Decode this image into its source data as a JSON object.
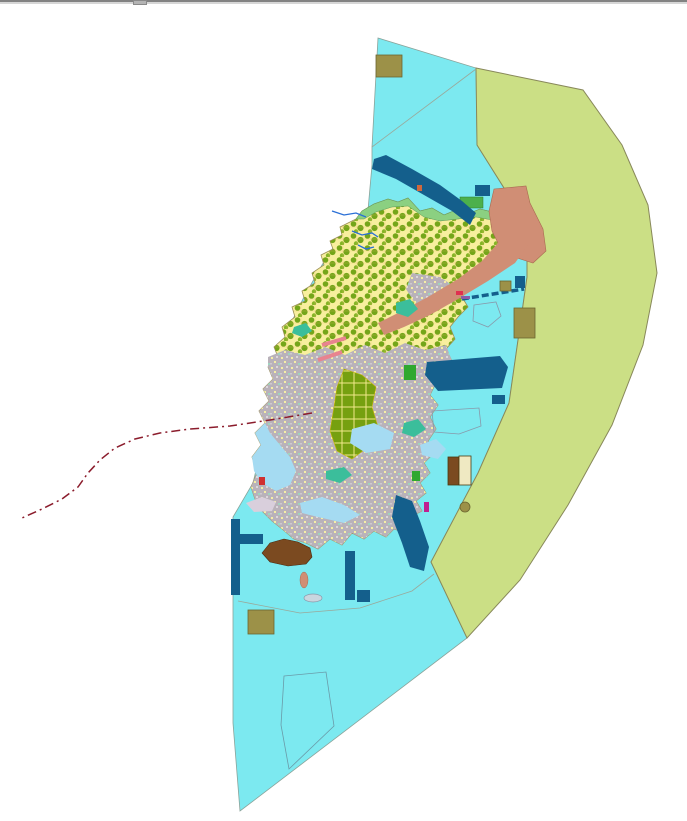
{
  "window": {
    "top_divider": {
      "present": true,
      "handle_x": 133
    }
  },
  "map": {
    "background": "#FFFFFF",
    "palette": {
      "sea": "#7CE9F0",
      "coastal_zone": "#CBDF85",
      "farmland_yellow": "#F8EF9E",
      "forest_green": "#74A619",
      "urban_gray": "#B9B2BA",
      "shore_green": "#8BD081",
      "salmon_zone": "#D08E75",
      "harbor_blue": "#145F8C",
      "khaki_site": "#9C9148",
      "brown_site": "#7B4A20",
      "beige_site": "#EFE9C2",
      "inlet_blue": "#A5DBF2",
      "teal_patch": "#3BBE9B",
      "boundary_maroon": "#8B1C2C",
      "outline_gray": "#8899AA",
      "stream_blue": "#2A6FD6",
      "pink_road": "#E8838F"
    },
    "features": [
      {
        "name": "sea-area",
        "type": "polygon",
        "fill": "#7CE9F0",
        "stroke": "#8aa39a",
        "stroke_width": 0.8,
        "points": "378,33 476,63 477,140 504,183 527,250 527,272 509,398 478,468 431,557 467,633 240,806 233,718 233,512 253,478 262,440 270,400 278,360 290,320 305,290 322,260 338,235 352,218 368,205 372,160 372,142"
      },
      {
        "name": "coastal-zone-area",
        "type": "polygon",
        "fill": "#CBDF85",
        "stroke": "#88885A",
        "stroke_width": 1,
        "points": "476,63 583,85 622,140 648,200 657,268 643,340 612,420 568,500 520,575 467,633 431,557 478,468 509,398 527,272 527,250 504,183 477,140"
      },
      {
        "name": "sea-boundary-line-nw",
        "type": "polyline",
        "stroke": "#9aa89a",
        "stroke_width": 0.8,
        "points": "372,142 476,64"
      },
      {
        "name": "sea-boundary-line-south",
        "type": "polyline",
        "stroke": "#9aa89a",
        "stroke_width": 0.8,
        "points": "238,596 300,608 360,603 412,586 434,569"
      },
      {
        "name": "island-base",
        "type": "polygon",
        "fill": "pattern:farmland",
        "stroke": "#9a8f55",
        "stroke_width": 0.8,
        "points": "356,214 362,206 374,199 388,194 398,197 408,193 420,206 432,203 444,210 456,205 468,209 480,204 492,207 500,203 508,210 514,218 520,228 518,240 508,252 496,262 484,272 470,282 462,292 468,302 458,312 450,322 455,334 446,344 452,356 444,362 434,358 428,366 436,378 430,390 438,400 430,412 436,424 428,436 434,448 424,458 430,468 420,478 426,488 416,496 422,506 410,512 414,520 402,518 406,528 394,524 386,532 374,526 364,534 352,528 342,540 330,534 318,544 306,538 294,534 282,524 272,516 262,506 255,494 251,482 257,468 252,452 261,440 255,428 265,418 259,406 269,396 263,384 273,374 268,362 278,352 274,342 285,332 282,322 295,312 292,302 305,296 302,286 315,278 312,268 324,260 321,250 333,244 330,236 342,230 340,222 352,216"
      },
      {
        "name": "island-urban-district",
        "type": "polygon",
        "fill": "pattern:urban",
        "points": "268,352 285,345 305,350 325,342 345,350 365,340 385,348 405,338 425,345 446,340 452,356 444,362 434,358 428,366 436,378 430,390 438,400 430,412 436,424 428,436 434,448 424,458 430,468 420,478 426,488 416,496 422,506 410,512 414,520 402,518 406,528 394,524 386,532 374,526 364,534 352,528 342,540 330,534 318,544 306,538 294,534 282,524 272,516 262,506 255,494 251,482 257,468 252,452 261,440 255,428 265,418 259,406 269,396 263,384 273,374 268,362"
      },
      {
        "name": "urban-patch-northeast",
        "type": "polygon",
        "fill": "pattern:urban",
        "points": "412,268 440,272 458,284 452,298 432,305 415,298 406,284"
      },
      {
        "name": "shore-green-strip-north",
        "type": "polygon",
        "fill": "#8BD081",
        "stroke": "#5f9a58",
        "stroke_width": 0.5,
        "points": "356,214 362,206 374,199 388,194 398,197 408,193 420,206 432,203 444,210 456,205 468,209 480,204 492,207 500,203 508,210 514,218 506,222 492,215 476,212 458,214 440,216 424,212 408,201 392,202 376,207 364,214"
      },
      {
        "name": "salmon-zone-northeast",
        "type": "polygon",
        "fill": "#D08E75",
        "stroke": "#a86a50",
        "stroke_width": 0.6,
        "points": "494,184 526,181 530,198 543,224 546,246 533,258 514,252 500,242 492,226 489,206"
      },
      {
        "name": "salmon-band-east-coast",
        "type": "polygon",
        "fill": "#D08E75",
        "points": "505,230 528,240 515,258 488,276 458,294 430,310 404,322 384,330 378,318 398,308 428,292 458,274 482,256"
      },
      {
        "name": "forest-cluster-central",
        "type": "polygon",
        "fill": "pattern:olive",
        "stroke": "#C8B400",
        "stroke_width": 0.6,
        "points": "344,364 362,370 376,382 372,402 378,422 368,442 352,454 337,446 330,426 334,402 337,382"
      },
      {
        "name": "inlet-west-bay",
        "type": "polygon",
        "fill": "#A5DBF2",
        "points": "252,452 261,440 255,428 265,418 270,428 280,440 290,452 296,466 290,480 276,486 262,478 254,466"
      },
      {
        "name": "inlet-mid-south",
        "type": "polygon",
        "fill": "#A5DBF2",
        "points": "352,424 374,418 394,428 390,444 366,448 350,438"
      },
      {
        "name": "inlet-south",
        "type": "polygon",
        "fill": "#A5DBF2",
        "points": "300,498 322,492 344,500 360,510 344,518 318,512 302,508"
      },
      {
        "name": "inlet-southeast",
        "type": "polygon",
        "fill": "#A5DBF2",
        "points": "420,440 436,434 446,444 438,454 422,450"
      },
      {
        "name": "teal-patch-1",
        "type": "polygon",
        "fill": "#3BBE9B",
        "points": "396,298 410,294 418,304 408,312 396,308"
      },
      {
        "name": "teal-patch-2",
        "type": "polygon",
        "fill": "#3BBE9B",
        "points": "404,418 418,414 426,424 414,432 402,428"
      },
      {
        "name": "teal-patch-3",
        "type": "polygon",
        "fill": "#3BBE9B",
        "points": "326,466 344,462 352,470 340,478 326,474"
      },
      {
        "name": "teal-patch-4",
        "type": "polygon",
        "fill": "#3BBE9B",
        "points": "294,322 306,318 312,326 302,332 292,328"
      },
      {
        "name": "green-site-1",
        "type": "rect",
        "x": 404,
        "y": 360,
        "w": 12,
        "h": 15,
        "fill": "#2FA82F"
      },
      {
        "name": "green-site-2",
        "type": "rect",
        "x": 412,
        "y": 466,
        "w": 8,
        "h": 10,
        "fill": "#2FA82F"
      },
      {
        "name": "green-site-shore",
        "type": "rect",
        "x": 460,
        "y": 192,
        "w": 23,
        "h": 11,
        "fill": "#4CB04C",
        "stroke": "#2a7a2a",
        "stroke_width": 0.5
      },
      {
        "name": "breakwater-northwest",
        "type": "polygon",
        "fill": "#145F8C",
        "points": "374,154 386,150 412,164 440,180 462,196 476,208 470,220 452,206 424,190 396,174 372,164"
      },
      {
        "name": "harbor-rect-north-1",
        "type": "rect",
        "x": 475,
        "y": 180,
        "w": 15,
        "h": 11,
        "fill": "#145F8C"
      },
      {
        "name": "harbor-rect-north-2",
        "type": "rect",
        "x": 456,
        "y": 199,
        "w": 7,
        "h": 8,
        "fill": "#145F8C"
      },
      {
        "name": "pier-dashed-east",
        "type": "polyline",
        "stroke": "#145F8C",
        "stroke_width": 3.5,
        "dash": "7 3",
        "points": "462,294 524,284"
      },
      {
        "name": "harbor-rect-east-upper",
        "type": "rect",
        "x": 515,
        "y": 271,
        "w": 10,
        "h": 12,
        "fill": "#145F8C"
      },
      {
        "name": "harbor-east-basin",
        "type": "polygon",
        "fill": "#145F8C",
        "points": "427,357 500,351 508,362 502,383 438,386 425,370"
      },
      {
        "name": "harbor-rect-east-lower",
        "type": "rect",
        "x": 492,
        "y": 390,
        "w": 13,
        "h": 9,
        "fill": "#145F8C"
      },
      {
        "name": "harbor-band-southeast",
        "type": "polygon",
        "fill": "#145F8C",
        "points": "396,490 412,496 420,516 429,542 424,566 410,562 402,538 392,512"
      },
      {
        "name": "harbor-bar-south",
        "type": "rect",
        "x": 345,
        "y": 546,
        "w": 10,
        "h": 49,
        "fill": "#145F8C"
      },
      {
        "name": "harbor-square-south",
        "type": "rect",
        "x": 357,
        "y": 585,
        "w": 13,
        "h": 12,
        "fill": "#145F8C"
      },
      {
        "name": "harbor-bar-southwest",
        "type": "rect",
        "x": 231,
        "y": 514,
        "w": 9,
        "h": 76,
        "fill": "#145F8C"
      },
      {
        "name": "harbor-arm-southwest",
        "type": "rect",
        "x": 240,
        "y": 529,
        "w": 23,
        "h": 10,
        "fill": "#145F8C"
      },
      {
        "name": "khaki-site-north",
        "type": "rect",
        "x": 376,
        "y": 50,
        "w": 26,
        "h": 22,
        "fill": "#9C9148",
        "stroke": "#6b6530",
        "stroke_width": 0.8
      },
      {
        "name": "khaki-site-east-large",
        "type": "rect",
        "x": 514,
        "y": 303,
        "w": 21,
        "h": 30,
        "fill": "#9C9148",
        "stroke": "#6b6530",
        "stroke_width": 0.8
      },
      {
        "name": "khaki-site-east-small",
        "type": "rect",
        "x": 500,
        "y": 276,
        "w": 11,
        "h": 10,
        "fill": "#9C9148",
        "stroke": "#6b6530",
        "stroke_width": 0.8
      },
      {
        "name": "khaki-site-south",
        "type": "rect",
        "x": 248,
        "y": 605,
        "w": 26,
        "h": 24,
        "fill": "#9C9148",
        "stroke": "#6b6530",
        "stroke_width": 0.8
      },
      {
        "name": "khaki-buoy-southeast",
        "type": "ellipse",
        "cx": 465,
        "cy": 502,
        "rx": 5,
        "ry": 5,
        "fill": "#9C9148",
        "stroke": "#6b6530",
        "stroke_width": 0.8
      },
      {
        "name": "brown-islet-south",
        "type": "polygon",
        "fill": "#7B4A20",
        "stroke": "#4a2a10",
        "stroke_width": 0.6,
        "points": "262,548 270,538 284,534 298,537 310,543 312,552 306,559 288,561 270,557"
      },
      {
        "name": "brown-site-east",
        "type": "rect",
        "x": 448,
        "y": 452,
        "w": 11,
        "h": 28,
        "fill": "#7B4A20",
        "stroke": "#4a3a10",
        "stroke_width": 0.8
      },
      {
        "name": "beige-site-east",
        "type": "rect",
        "x": 459,
        "y": 451,
        "w": 12,
        "h": 29,
        "fill": "#EFE9C2",
        "stroke": "#4a3a10",
        "stroke_width": 0.8
      },
      {
        "name": "survey-polygon-east-pentagon",
        "type": "polygon",
        "fill": "none",
        "stroke": "#8899AA",
        "stroke_width": 0.8,
        "points": "474,300 496,297 501,311 488,322 473,316"
      },
      {
        "name": "survey-polygon-east-rect",
        "type": "polygon",
        "fill": "none",
        "stroke": "#8899AA",
        "stroke_width": 0.8,
        "points": "432,406 479,403 481,421 459,429 434,427"
      },
      {
        "name": "survey-polygon-south-trapezoid",
        "type": "polygon",
        "fill": "none",
        "stroke": "#6a9aa8",
        "stroke_width": 0.8,
        "points": "284,671 326,667 334,721 289,764 281,720"
      },
      {
        "name": "stream-northwest-1",
        "type": "polyline",
        "stroke": "#2A6FD6",
        "stroke_width": 1.3,
        "points": "332,206 344,210 356,208 366,212"
      },
      {
        "name": "stream-northwest-2",
        "type": "polyline",
        "stroke": "#2A6FD6",
        "stroke_width": 1.3,
        "points": "352,226 362,230 372,228 378,232"
      },
      {
        "name": "stream-northwest-3",
        "type": "polyline",
        "stroke": "#2A6FD6",
        "stroke_width": 1.3,
        "points": "358,240 366,244 374,242"
      },
      {
        "name": "pink-road-west-1",
        "type": "polyline",
        "stroke": "#E8838F",
        "stroke_width": 4,
        "points": "322,340 346,333"
      },
      {
        "name": "pink-road-west-2",
        "type": "polyline",
        "stroke": "#E8838F",
        "stroke_width": 4,
        "points": "318,355 342,347"
      },
      {
        "name": "marker-red-west",
        "type": "rect",
        "x": 259,
        "y": 472,
        "w": 6,
        "h": 8,
        "fill": "#D03030"
      },
      {
        "name": "marker-orange-sea-north",
        "type": "rect",
        "x": 417,
        "y": 180,
        "w": 5,
        "h": 6,
        "fill": "#D0683C"
      },
      {
        "name": "marker-magenta-southeast",
        "type": "rect",
        "x": 424,
        "y": 497,
        "w": 5,
        "h": 10,
        "fill": "#C02090"
      },
      {
        "name": "marker-red-east",
        "type": "rect",
        "x": 456,
        "y": 286,
        "w": 7,
        "h": 4,
        "fill": "#E03050"
      },
      {
        "name": "marker-purple-east",
        "type": "rect",
        "x": 461,
        "y": 291,
        "w": 9,
        "h": 3,
        "fill": "#8B5CA8"
      },
      {
        "name": "islet-salmon-south",
        "type": "ellipse",
        "cx": 304,
        "cy": 575,
        "rx": 4,
        "ry": 8,
        "fill": "#D08E75",
        "stroke": "#a86a50",
        "stroke_width": 0.5
      },
      {
        "name": "islet-gray-south",
        "type": "ellipse",
        "cx": 313,
        "cy": 593,
        "rx": 9,
        "ry": 4,
        "fill": "#C9D6DF",
        "stroke": "#8899AA",
        "stroke_width": 0.7
      },
      {
        "name": "islet-lavender-southwest",
        "type": "polygon",
        "fill": "#D9CFDC",
        "points": "246,498 262,492 276,497 272,506 254,507"
      },
      {
        "name": "boundary-dashed-maroon",
        "type": "polyline",
        "stroke": "#8B1C2C",
        "stroke_width": 1.5,
        "dash": "9 4 2 4",
        "points": "312,408 270,415 230,421 190,424 160,428 135,434 115,443 100,455 88,468 78,482 62,494 42,504 22,513"
      }
    ]
  }
}
